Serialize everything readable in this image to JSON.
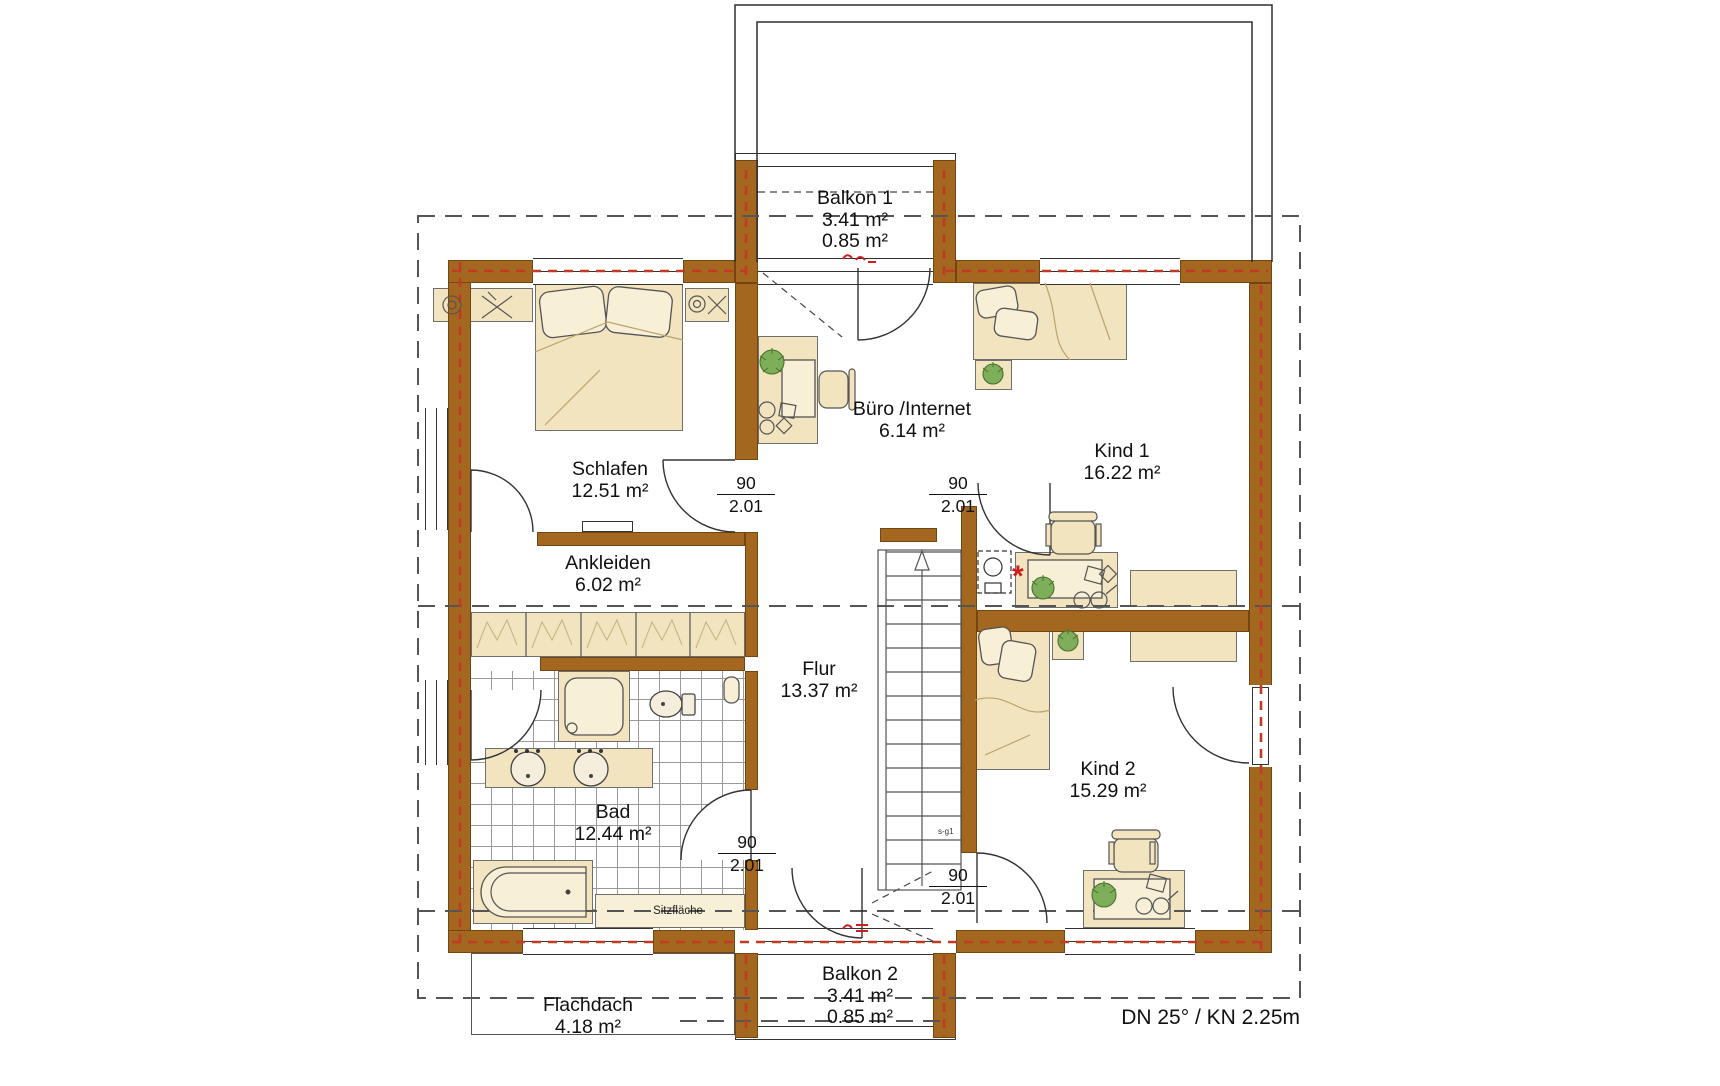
{
  "plan": {
    "rooms": [
      {
        "name": "Balkon 1",
        "area": "3.41 m²",
        "area2": "0.85 m²"
      },
      {
        "name": "Büro /Internet",
        "area": "6.14 m²"
      },
      {
        "name": "Schlafen",
        "area": "12.51 m²"
      },
      {
        "name": "Kind 1",
        "area": "16.22 m²"
      },
      {
        "name": "Ankleiden",
        "area": "6.02 m²"
      },
      {
        "name": "Flur",
        "area": "13.37 m²"
      },
      {
        "name": "Bad",
        "area": "12.44 m²"
      },
      {
        "name": "Kind 2",
        "area": "15.29 m²"
      },
      {
        "name": "Balkon 2",
        "area": "3.41 m²",
        "area2": "0.85 m²"
      },
      {
        "name": "Flachdach",
        "area": "4.18 m²"
      }
    ],
    "door_label": {
      "width": "90",
      "height": "2.01"
    },
    "annotations": {
      "seat": "Sitzfläche",
      "roof_note": "DN 25° / KN 2.25m",
      "stair_note": "s-g1",
      "marker": "*"
    }
  },
  "colors": {
    "wall": "#a4671f",
    "furniture": "#f2e4bf",
    "furniture_light": "#f8efd7",
    "tile_line": "#9a9a9a",
    "dash": "#555555",
    "red_dash": "#c13a26",
    "accent_red": "#cc1f1f",
    "plant": "#7fae5a",
    "line": "#333333"
  }
}
